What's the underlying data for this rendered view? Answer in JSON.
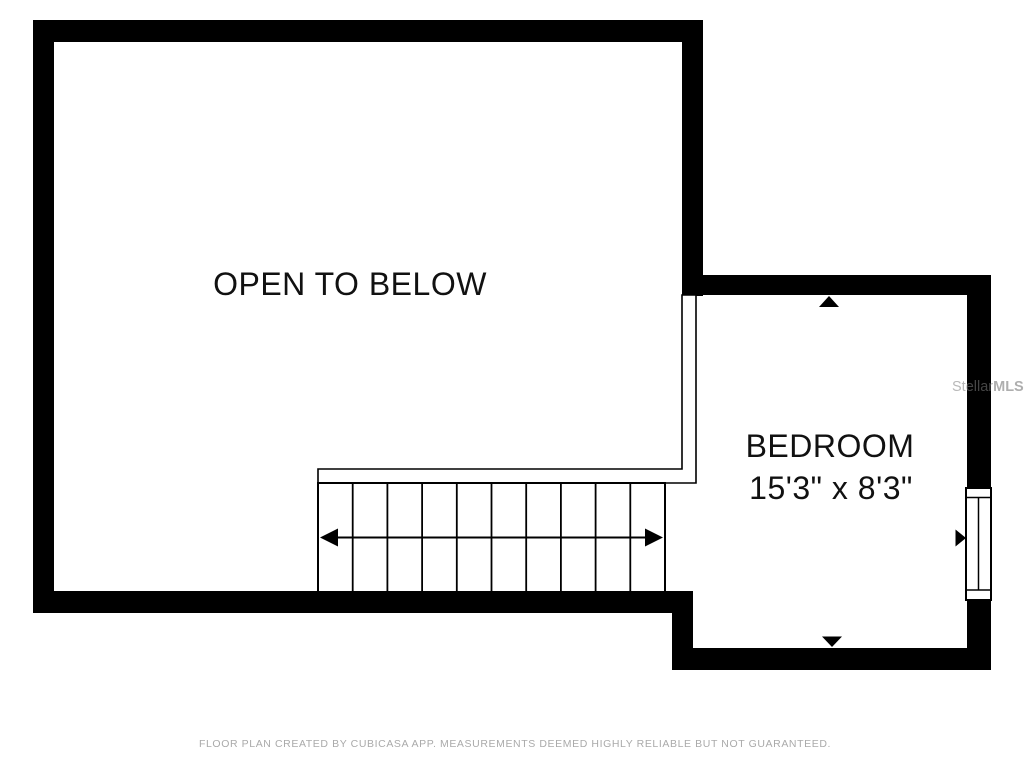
{
  "colors": {
    "wall": "#000000",
    "background": "#ffffff",
    "disclaimer_text": "#aaaaaa"
  },
  "rooms": {
    "open_area": {
      "label": "OPEN TO BELOW"
    },
    "bedroom": {
      "name": "BEDROOM",
      "dimensions": "15'3\" x 8'3\""
    }
  },
  "stairs": {
    "tread_count": 10
  },
  "watermark": {
    "brand_regular": "Stellar",
    "brand_bold": "MLS"
  },
  "footer": {
    "disclaimer": "FLOOR PLAN CREATED BY CUBICASA APP. MEASUREMENTS DEEMED HIGHLY RELIABLE BUT NOT GUARANTEED."
  }
}
